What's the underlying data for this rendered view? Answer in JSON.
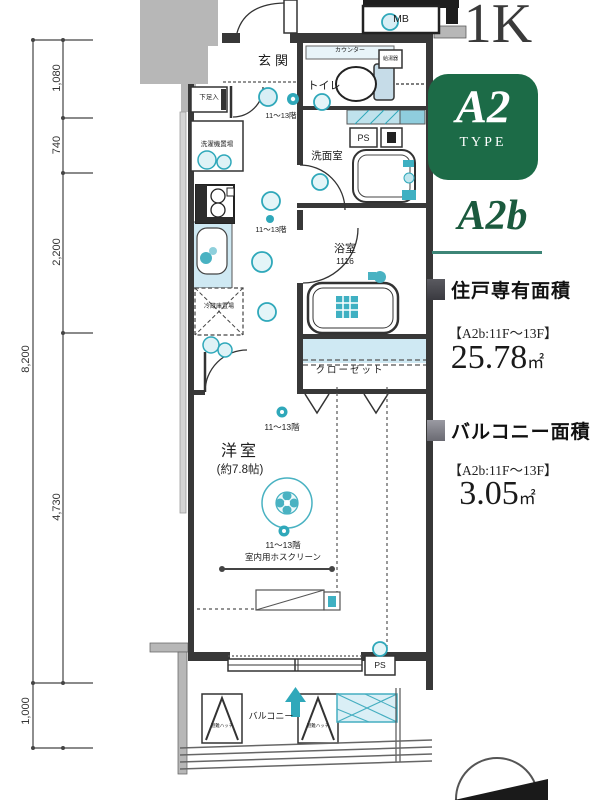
{
  "header": {
    "plan_type": "1K",
    "type_badge_main": "A2",
    "type_badge_sub": "TYPE",
    "plan_code": "A2b"
  },
  "areas": {
    "unit_heading": "住戸専有面積",
    "unit_floors": "【A2b:11F〜13F】",
    "unit_value": "25.78",
    "unit_unit": "㎡",
    "balcony_heading": "バルコニー面積",
    "balcony_floors": "【A2b:11F〜13F】",
    "balcony_value": "3.05",
    "balcony_unit": "㎡"
  },
  "dimensions": {
    "overall": "8,200",
    "seg1": "1,080",
    "seg2": "740",
    "seg3": "2,200",
    "seg4": "4,730",
    "seg5": "1,000"
  },
  "plan": {
    "entrance": "玄関",
    "toilet": "トイレ",
    "counter": "カウンター",
    "water_heater": "給湯器",
    "washroom": "洗面室",
    "ps": "PS",
    "ps_lower": "PS",
    "bathroom": "浴室",
    "bathroom_module": "1116",
    "shoe_cabinet": "下足入",
    "washer_space": "洗濯機置場",
    "fridge_space": "冷蔵庫置場",
    "closet": "クローゼット",
    "western_room": "洋室",
    "western_room_size": "(約7.8帖)",
    "floors_note_1": "11〜13階",
    "floors_note_2": "11〜13階",
    "floors_note_3": "11〜13階",
    "floors_note_4": "11〜13階",
    "hoscreen": "室内用ホスクリーン",
    "balcony": "バルコニー",
    "escape_hatch_left": "避難ハッチ",
    "escape_hatch_right": "避難ハッチ",
    "meter_box": "MB"
  },
  "colors": {
    "badge_green": "#1c6b47",
    "code_green": "#1b5a3e",
    "divider_teal": "#3d8577",
    "accent_teal": "#2fa8ba",
    "light_blue": "#cfe9f3",
    "wall": "#383838",
    "gray": "#b7b7b7"
  }
}
